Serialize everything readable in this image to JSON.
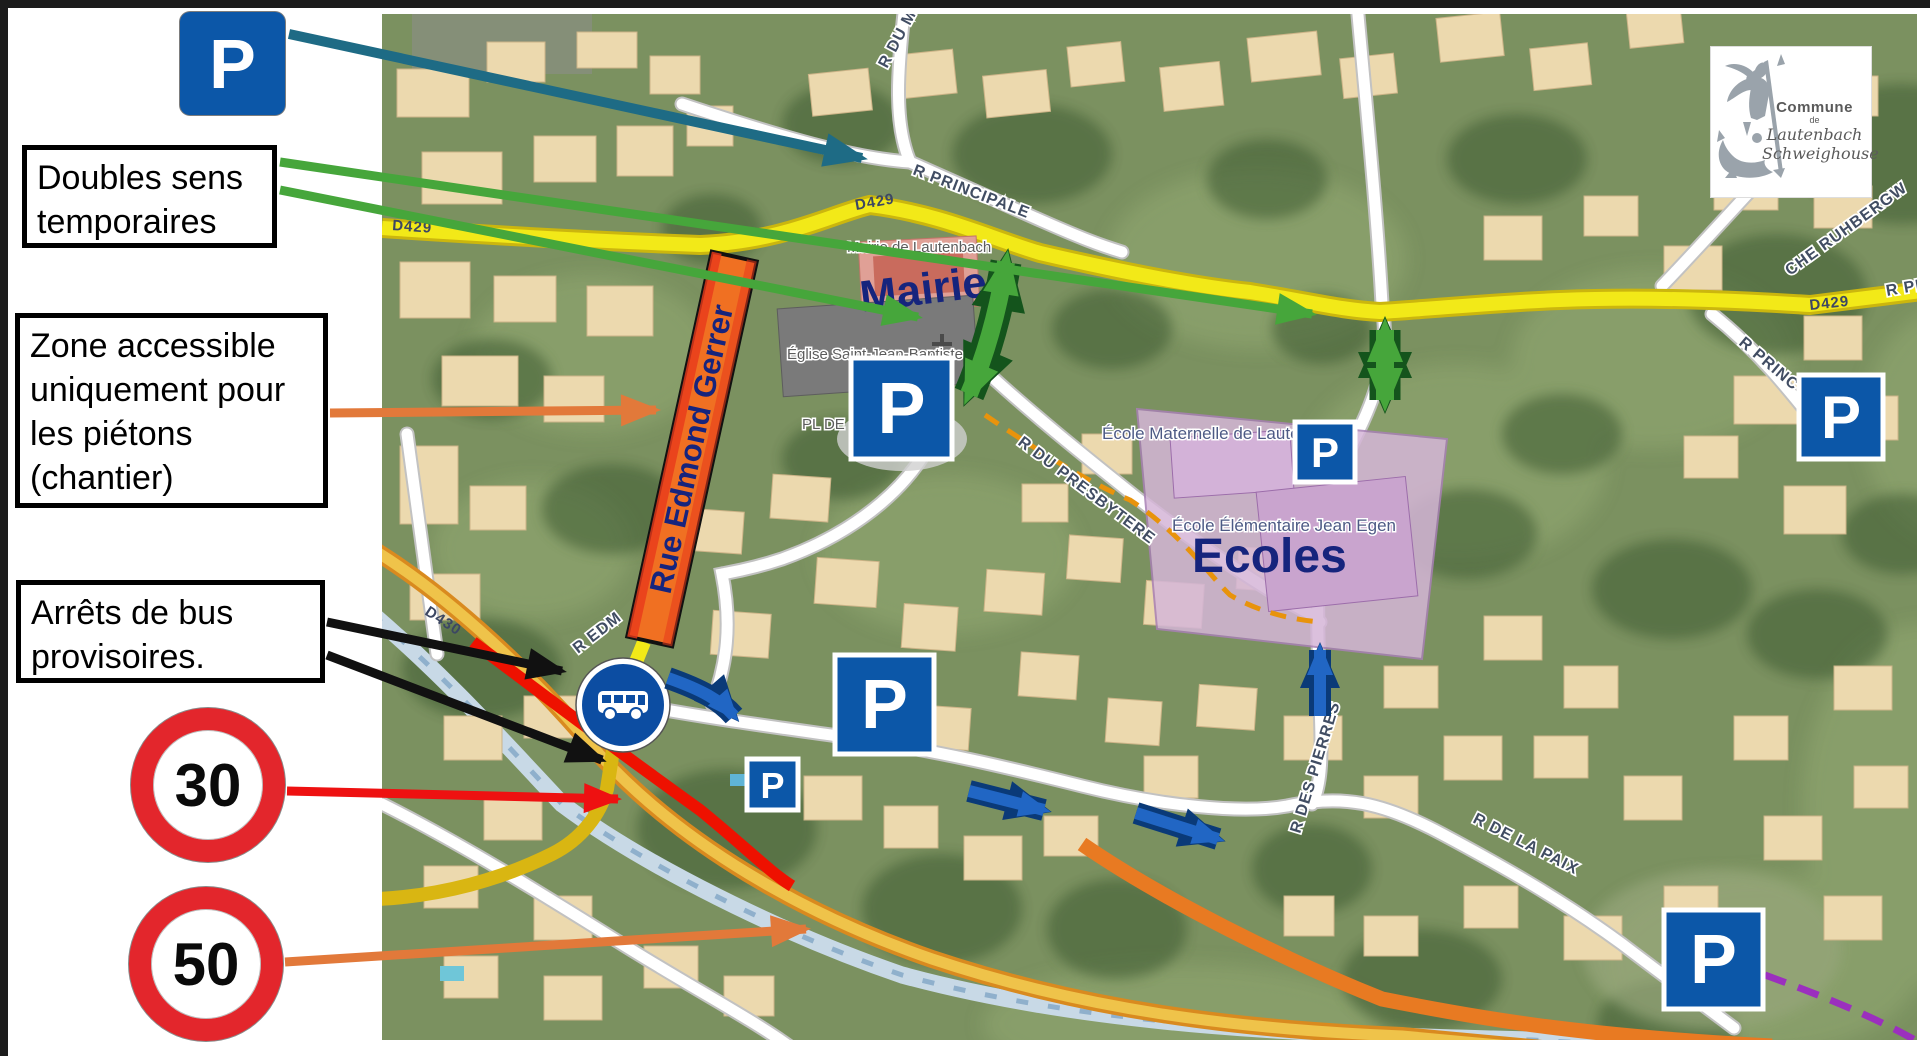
{
  "signs": {
    "parking": "P",
    "speed_30": "30",
    "speed_50": "50"
  },
  "sidebar": {
    "boxes": {
      "doubles_sens": {
        "line1": "Doubles sens",
        "line2": "temporaires"
      },
      "zone": {
        "line1": "Zone accessible",
        "line2": "uniquement pour",
        "line3": "les piétons",
        "line4": "(chantier)"
      },
      "arrets": {
        "line1": "Arrêts de bus",
        "line2": "provisoires."
      }
    }
  },
  "logo": {
    "l1": "Commune",
    "l2": "de",
    "l3": "Lautenbach",
    "l4": "Schweighouse"
  },
  "map": {
    "labels": {
      "mairie": "Mairie",
      "ecoles": "Ecoles",
      "rue_edmond_gerrer": "Rue Edmond Gerrer",
      "pl_lautenbach": "Mairie de Lautenbach",
      "eglise": "Église Saint-Jean-Baptiste",
      "pl_eglise": "PL DE L'EGLISE",
      "maternelle": "École Maternelle de Lautenbach",
      "elementaire": "École Élémentaire Jean Egen"
    },
    "streets": {
      "r_du_moulin": "R DU MOULIN",
      "r_principale": "R PRINCIPALE",
      "r_princ_right": "R PRINC",
      "r_pr": "R PR",
      "d429_w": "D429",
      "d429_c": "D429",
      "d429_e": "D429",
      "d430": "D430",
      "r_edm": "R EDM",
      "r_du_presbytere": "R DU PRESBYTERE",
      "r_des_pierres": "R DES PIERRES",
      "r_de_la_paix": "R DE LA PAIX",
      "che_ruhberg": "CHE RUHBERGW"
    }
  },
  "colors": {
    "parking_blue": "#0c57a8",
    "sign_red": "#e3262c",
    "arrow_green": "#46a63b",
    "arrow_green_dark": "#14541c",
    "arrow_teal": "#1e6b85",
    "arrow_orange": "#e2793a",
    "arrow_red": "#ee1111",
    "arrow_black": "#111111",
    "arrow_blue": "#2166c4",
    "arrow_blue_dark": "#0a3a78",
    "route_orange": "#e87a22",
    "road_yellow": "#f2e918",
    "navy_text": "#16247d",
    "purple_route": "#9b2fbe"
  }
}
